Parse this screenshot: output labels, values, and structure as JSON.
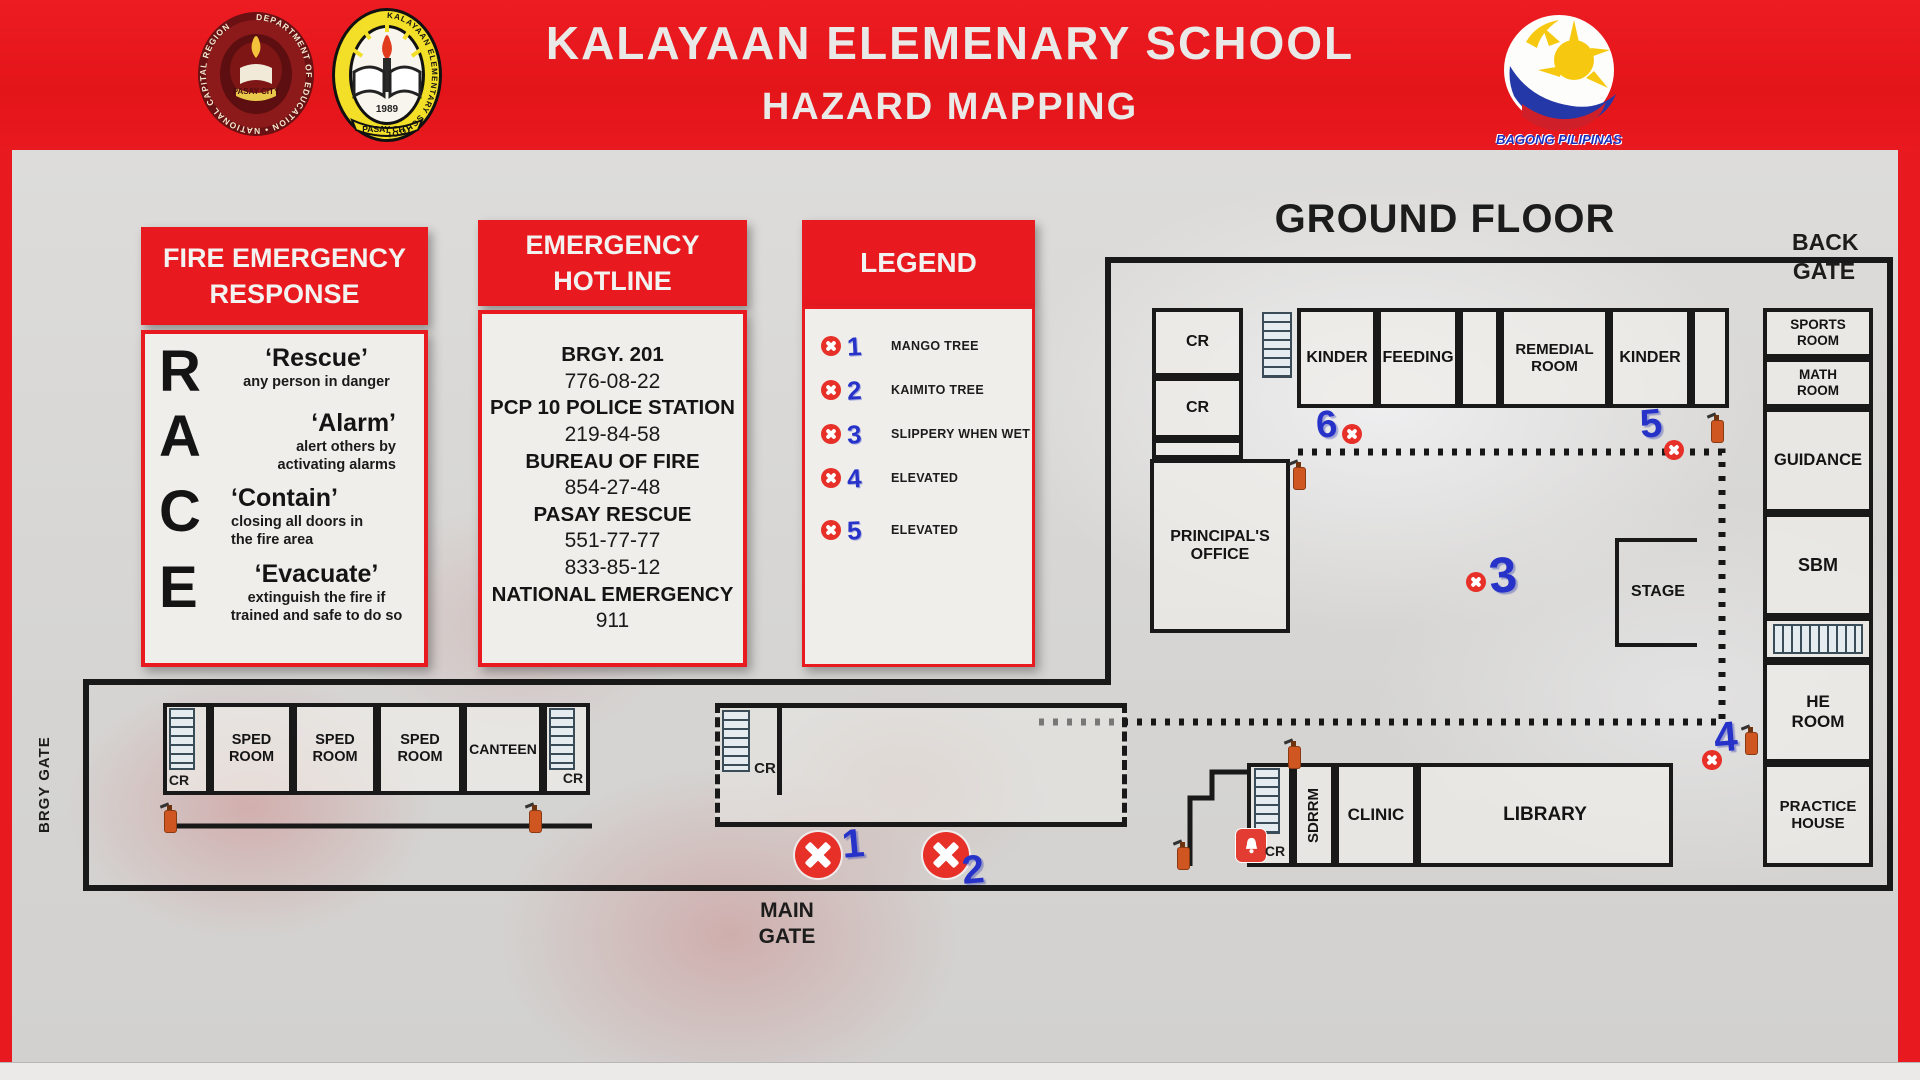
{
  "header": {
    "title": "KALAYAAN ELEMENARY SCHOOL",
    "subtitle": "HAZARD MAPPING",
    "deped_seal": {
      "ring_text": "DEPARTMENT OF EDUCATION • NATIONAL CAPITAL REGION",
      "banner": "PASAY CITY"
    },
    "school_seal": {
      "ring_text": "KALAYAAN ELEMENTARY SCHOOL",
      "year": "1989",
      "banner": "PASAY CITY"
    },
    "bagong_pilipinas": {
      "caption": "BAGONG PILIPINAS"
    }
  },
  "panels": {
    "fire_response": {
      "title_line1": "FIRE EMERGENCY",
      "title_line2": "RESPONSE",
      "items": [
        {
          "letter": "R",
          "word": "‘Rescue’",
          "desc": "any person in danger"
        },
        {
          "letter": "A",
          "word": "‘Alarm’",
          "desc": "alert others by activating alarms"
        },
        {
          "letter": "C",
          "word": "‘Contain’",
          "desc": "closing all doors in the fire area"
        },
        {
          "letter": "E",
          "word": "‘Evacuate’",
          "desc": "extinguish the fire if trained and safe to do so"
        }
      ]
    },
    "hotline": {
      "title_line1": "EMERGENCY",
      "title_line2": "HOTLINE",
      "entries": [
        {
          "name": "BRGY. 201",
          "numbers": [
            "776-08-22"
          ]
        },
        {
          "name": "PCP 10 POLICE STATION",
          "numbers": [
            "219-84-58"
          ]
        },
        {
          "name": "BUREAU OF FIRE",
          "numbers": [
            "854-27-48"
          ]
        },
        {
          "name": "PASAY RESCUE",
          "numbers": [
            "551-77-77",
            "833-85-12"
          ]
        },
        {
          "name": "NATIONAL EMERGENCY",
          "numbers": [
            "911"
          ]
        }
      ]
    },
    "legend": {
      "title": "LEGEND",
      "items": [
        {
          "number": "1",
          "label": "MANGO TREE"
        },
        {
          "number": "2",
          "label": "KAIMITO TREE"
        },
        {
          "number": "3",
          "label": "SLIPPERY WHEN WET"
        },
        {
          "number": "4",
          "label": "ELEVATED"
        },
        {
          "number": "5",
          "label": "ELEVATED"
        }
      ]
    }
  },
  "map": {
    "floor_title": "GROUND FLOOR",
    "gates": {
      "back": "BACK GATE",
      "main": "MAIN GATE",
      "brgy": "BRGY GATE"
    },
    "rooms": {
      "cr_top": "CR",
      "cr_mid": "CR",
      "principals_office": "PRINCIPAL'S OFFICE",
      "kinder_1": "KINDER",
      "feeding": "FEEDING",
      "remedial": "REMEDIAL ROOM",
      "kinder_2": "KINDER",
      "sports": "SPORTS ROOM",
      "math": "MATH ROOM",
      "guidance": "GUIDANCE",
      "sbm": "SBM",
      "he_room": "HE ROOM",
      "practice_house": "PRACTICE HOUSE",
      "stage": "STAGE",
      "sdrrm": "SDRRM",
      "clinic": "CLINIC",
      "library": "LIBRARY",
      "cr_lower": "CR",
      "cr_left": "CR",
      "sped_1": "SPED ROOM",
      "sped_2": "SPED ROOM",
      "sped_3": "SPED ROOM",
      "canteen": "CANTEEN",
      "cr_right": "CR",
      "cr_middle_bldg": "CR"
    },
    "markers": {
      "m1": "1",
      "m2": "2",
      "m3": "3",
      "m4": "4",
      "m5": "5",
      "m6": "6"
    }
  },
  "colors": {
    "brand_red": "#e8191f",
    "marker_blue": "#2733c8",
    "hazard_red": "#e63028",
    "extinguisher_orange": "#cf5620"
  },
  "icons": {
    "hazard": "x-circle-icon",
    "stairs": "stairs-icon",
    "extinguisher": "fire-extinguisher-icon",
    "alarm": "alarm-bell-icon"
  }
}
